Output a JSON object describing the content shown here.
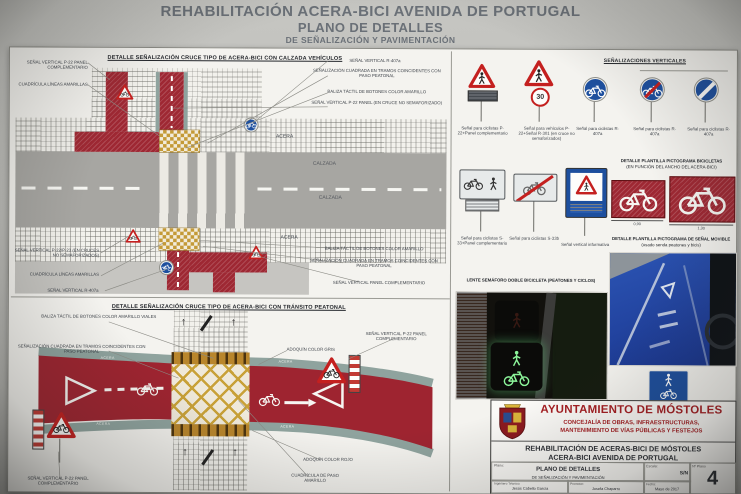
{
  "colors": {
    "sheet": "#f4f3ef",
    "red_lane": "#9e2833",
    "sign_red": "#c4201f",
    "sign_blue": "#1d4f9e",
    "yellow": "#c49a37",
    "teal": "#8fa39e",
    "road": "#a7a6a2",
    "header_text": "#6a7077",
    "block_red": "#a51e22"
  },
  "header": {
    "line1": "REHABILITACIÓN ACERA-BICI AVENIDA DE PORTUGAL",
    "line2": "PLANO DE DETALLES",
    "line3": "DE SEÑALIZACIÓN Y PAVIMENTACIÓN"
  },
  "panel_calzada": {
    "title": "DETALLE SEÑALIZACIÓN CRUCE TIPO DE ACERA-BICI CON CALZADA VEHÍCULOS",
    "acera": "ACERA",
    "calzada": "CALZADA",
    "lbl_p22_panel": "SEÑAL VERTICAL P-22 PANEL COMPLEMENTARIO",
    "lbl_cuadricula": "CUADRÍCULA LÍNEAS AMARILLAS",
    "lbl_r407a": "SEÑAL VERTICAL R-407a",
    "lbl_cuadrada": "SEÑALIZACIÓN CUADRADA EN TRAMOS COINCIDENTES CON PASO PEATONAL",
    "lbl_baliza": "BALIZA TÁCTIL DE BOTONES COLOR AMARILLO",
    "lbl_p22_cruce": "SEÑAL VERTICAL P-22 PANEL (EN CRUCE NO SEMAFORIZADO)",
    "lbl_p22_p23": "SEÑAL VERTICAL P-22/P-23 (EN CRUCES NO SEMAFORIZADOS)",
    "lbl_panel_comp": "SEÑAL VERTICAL PANEL COMPLEMENTARIO"
  },
  "panel_peatonal": {
    "title": "DETALLE SEÑALIZACIÓN CRUCE TIPO DE ACERA-BICI CON TRÁNSITO PEATONAL",
    "lbl_baliza_viales": "BALIZA TÁCTIL DE BOTONES COLOR AMARILLO VIALES",
    "lbl_cuadrada": "SEÑALIZACIÓN CUADRADA EN TRAMOS COINCIDENTES CON PASO PEATONAL",
    "lbl_adoquin_gris": "ADOQUÍN COLOR GRIS",
    "lbl_p22_panel": "SEÑAL VERTICAL P-22 PANEL COMPLEMENTARIO",
    "lbl_adoquin_rojo": "ADOQUÍN COLOR ROJO",
    "lbl_cuadricula_paso": "CUADRÍCULA DE PASO AMARILLO",
    "band_label": "ACERA"
  },
  "senales": {
    "title": "SEÑALIZACIONES VERTICALES",
    "cap_p22_panel": "Señal para ciclistas P-22+Panel complementario",
    "cap_p22_r301": "Señal para vehículos P-22+Señal R-301 (en cruce no semaforizados)",
    "cap_r407a": "Señal para ciclistas R-407a",
    "cap_s33_panel": "Señal para ciclistas S-33+Panel complementario",
    "cap_s33b": "Señal para ciclistas S-33b",
    "cap_informativa": "Señal vertical informativa",
    "speed": "30"
  },
  "plantilla_bici": {
    "title": "DETALLE PLANTILLA PICTOGRAMA BICICLETAS",
    "subtitle": "(EN FUNCIÓN DEL ANCHO DEL ACERA-BICI)",
    "dim_small": "0,90",
    "dim_large": "1,30"
  },
  "plantilla_senal": {
    "title": "DETALLE PLANTILLA PICTOGRAMA DE SEÑAL MOVIBLE",
    "subtitle": "(usado senda peatones y bicis)"
  },
  "semaforo": {
    "title": "LENTE SEMÁFORO DOBLE BICICLETA (PEATONES Y CICLOS)"
  },
  "title_block": {
    "org": "AYUNTAMIENTO DE MÓSTOLES",
    "dept1": "CONCEJALÍA DE OBRAS, INFRAESTRUCTURAS,",
    "dept2": "MANTENIMIENTO DE VÍAS PÚBLICAS Y FESTEJOS",
    "project1": "REHABILITACIÓN DE ACERAS-BICI DE MÓSTOLES",
    "project2": "ACERA-BICI AVENIDA DE PORTUGAL",
    "plano_label": "Plano:",
    "plano1": "PLANO DE DETALLES",
    "plano2": "DE SEÑALIZACIÓN Y PAVIMENTACIÓN",
    "escala_label": "Escala:",
    "escala": "S/N",
    "num_label": "Nº Plano",
    "num": "4",
    "tecnico_label": "Ingeniero Técnico:",
    "tecnico": "Jesús Cabello García",
    "promotor_label": "Promotor:",
    "promotor": "Josefa Chaparro",
    "fecha_label": "Fecha:",
    "fecha": "Mayo de 2017"
  }
}
